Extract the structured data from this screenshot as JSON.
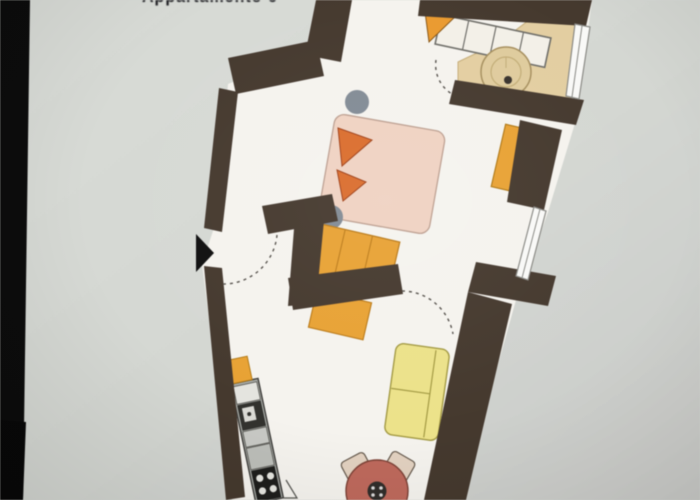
{
  "page": {
    "background_color": "#d6d9d4",
    "left_bar_color": "#0a0a0a",
    "partial_caption": "Appartamento 6"
  },
  "floorplan": {
    "wall_color": "#44372c",
    "floor_color": "#f7f5f0",
    "bathroom_floor_color": "#e6d0a0",
    "accent_orange": "#eda22e",
    "pillow_orange": "#e06c28",
    "bed_color": "#f2d3c2",
    "sofa_yellow": "#efe487",
    "table_terracotta": "#c2685a",
    "chair_beige": "#e5d3c0",
    "stool_gray": "#828b96",
    "rooms": [
      {
        "name": "bathroom"
      },
      {
        "name": "bedroom"
      },
      {
        "name": "hallway"
      },
      {
        "name": "living-kitchen"
      }
    ],
    "furniture": [
      "built-in-wardrobe",
      "corner-shelf",
      "washbasin",
      "double-bed",
      "pillows",
      "bedside-stools",
      "dresser",
      "hall-wardrobe",
      "lower-cabinet",
      "kitchen-counter",
      "sink",
      "stove",
      "upper-cabinet",
      "sofa",
      "dining-table",
      "chairs"
    ],
    "doors": [
      "entrance-door",
      "bathroom-door",
      "living-room-door"
    ],
    "windows": [
      "bathroom-window",
      "bedroom-window"
    ]
  }
}
